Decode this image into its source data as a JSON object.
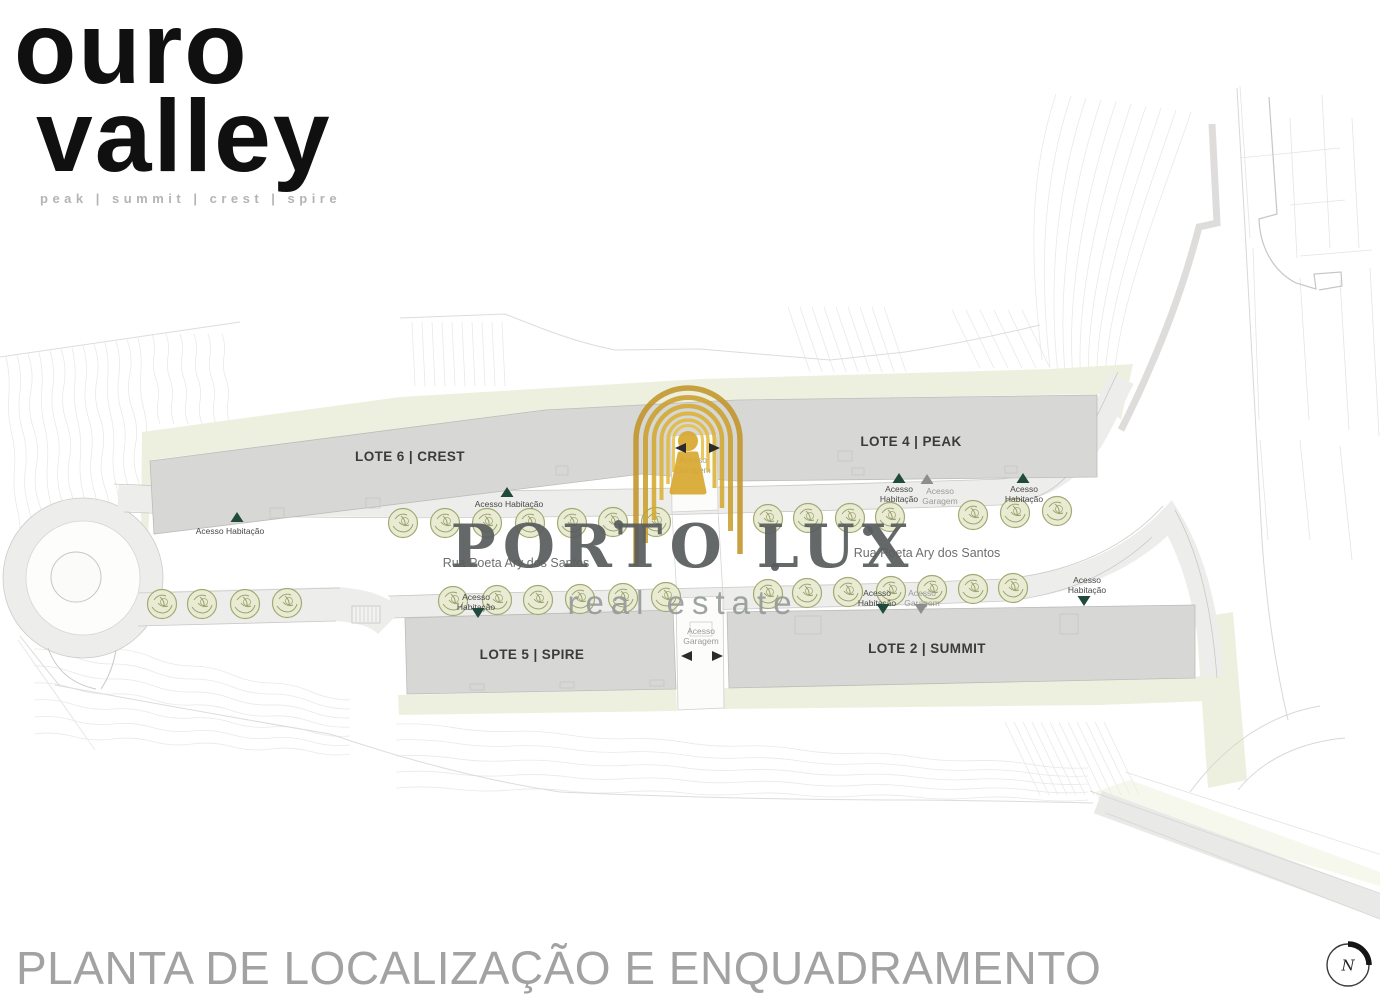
{
  "brand": {
    "name_line1": "ouro",
    "name_line2": "valley",
    "tagline": "peak | summit | crest | spire"
  },
  "watermark": {
    "wordmark": "PORTO LUX",
    "subtitle": "real estate",
    "gold": "#d2a02c",
    "text_color": "#585d5c"
  },
  "footer": {
    "title": "PLANTA DE LOCALIZAÇÃO E ENQUADRAMENTO"
  },
  "compass": {
    "letter": "N"
  },
  "plan": {
    "street_name": "Rua Poeta Ary dos Santos",
    "street_labels": [
      {
        "x": 516,
        "y": 556
      },
      {
        "x": 927,
        "y": 546
      }
    ],
    "lots": [
      {
        "label": "LOTE 6 | CREST",
        "x": 410,
        "y": 449
      },
      {
        "label": "LOTE 4 | PEAK",
        "x": 911,
        "y": 434
      },
      {
        "label": "LOTE 5 | SPIRE",
        "x": 532,
        "y": 647
      },
      {
        "label": "LOTE 2 | SUMMIT",
        "x": 927,
        "y": 641
      }
    ],
    "access_labels": [
      {
        "lines": [
          "Acesso Habitação"
        ],
        "x": 230,
        "y": 527,
        "tone": "dark"
      },
      {
        "lines": [
          "Acesso Habitação"
        ],
        "x": 509,
        "y": 500,
        "tone": "dark"
      },
      {
        "lines": [
          "Acesso",
          "Garagem"
        ],
        "x": 693,
        "y": 456,
        "tone": "gray"
      },
      {
        "lines": [
          "Acesso",
          "Habitação"
        ],
        "x": 899,
        "y": 485,
        "tone": "dark"
      },
      {
        "lines": [
          "Acesso",
          "Garagem"
        ],
        "x": 940,
        "y": 487,
        "tone": "gray"
      },
      {
        "lines": [
          "Acesso",
          "Habitação"
        ],
        "x": 1024,
        "y": 485,
        "tone": "dark"
      },
      {
        "lines": [
          "Acesso",
          "Habitação"
        ],
        "x": 1087,
        "y": 576,
        "tone": "dark"
      },
      {
        "lines": [
          "Acesso",
          "Habitação"
        ],
        "x": 877,
        "y": 589,
        "tone": "dark"
      },
      {
        "lines": [
          "Acesso",
          "Garagem"
        ],
        "x": 922,
        "y": 589,
        "tone": "gray"
      },
      {
        "lines": [
          "Acesso",
          "Habitação"
        ],
        "x": 476,
        "y": 593,
        "tone": "dark"
      },
      {
        "lines": [
          "Acesso",
          "Garagem"
        ],
        "x": 701,
        "y": 627,
        "tone": "gray"
      }
    ],
    "access_markers": [
      {
        "x": 237,
        "y": 512,
        "d": "up",
        "c": "green"
      },
      {
        "x": 507,
        "y": 487,
        "d": "up",
        "c": "green"
      },
      {
        "x": 899,
        "y": 473,
        "d": "up",
        "c": "green"
      },
      {
        "x": 927,
        "y": 474,
        "d": "up",
        "c": "gray"
      },
      {
        "x": 1023,
        "y": 473,
        "d": "up",
        "c": "green"
      },
      {
        "x": 478,
        "y": 608,
        "d": "down",
        "c": "green"
      },
      {
        "x": 883,
        "y": 604,
        "d": "down",
        "c": "green"
      },
      {
        "x": 921,
        "y": 604,
        "d": "down",
        "c": "gray"
      },
      {
        "x": 1084,
        "y": 596,
        "d": "down",
        "c": "green"
      },
      {
        "x": 681,
        "y": 443,
        "d": "left",
        "c": "black"
      },
      {
        "x": 714,
        "y": 443,
        "d": "right",
        "c": "black"
      },
      {
        "x": 687,
        "y": 651,
        "d": "left",
        "c": "black"
      },
      {
        "x": 717,
        "y": 651,
        "d": "right",
        "c": "black"
      }
    ],
    "trees": [
      [
        403,
        523
      ],
      [
        445,
        523
      ],
      [
        487,
        523
      ],
      [
        530,
        523
      ],
      [
        572,
        523
      ],
      [
        613,
        522
      ],
      [
        656,
        522
      ],
      [
        768,
        519
      ],
      [
        808,
        518
      ],
      [
        850,
        518
      ],
      [
        890,
        517
      ],
      [
        973,
        515
      ],
      [
        1015,
        513
      ],
      [
        1057,
        511
      ],
      [
        453,
        601
      ],
      [
        497,
        600
      ],
      [
        538,
        600
      ],
      [
        580,
        599
      ],
      [
        623,
        598
      ],
      [
        666,
        597
      ],
      [
        768,
        594
      ],
      [
        807,
        593
      ],
      [
        848,
        592
      ],
      [
        891,
        591
      ],
      [
        932,
        590
      ],
      [
        973,
        589
      ],
      [
        1013,
        588
      ],
      [
        162,
        604
      ],
      [
        202,
        604
      ],
      [
        245,
        604
      ],
      [
        287,
        603
      ]
    ],
    "colors": {
      "olive": "#eef0df",
      "building": "#d7d7d5",
      "tree_fill": "#e9ecd2",
      "tree_line": "#8d955f",
      "green_marker": "#1f4a3c",
      "gray_marker": "#8d8d8b",
      "black_marker": "#2b2b2b"
    }
  }
}
